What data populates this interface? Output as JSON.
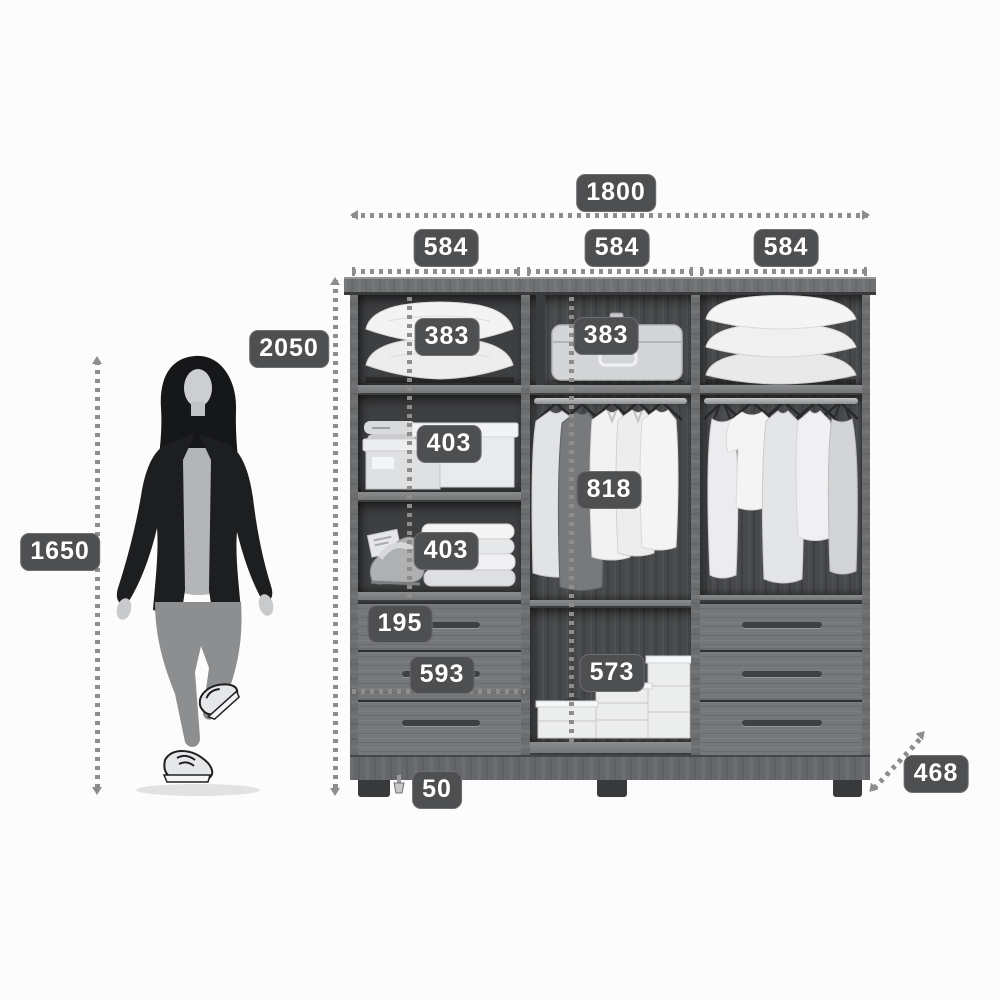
{
  "unit": "mm",
  "dimensions": {
    "width_total": "1800",
    "width_sections": [
      "584",
      "584",
      "584"
    ],
    "height_total": "2050",
    "person_height": "1650",
    "top_shelf_left": "383",
    "top_shelf_middle": "383",
    "middle_shelf_left": "403",
    "lower_shelf_left": "403",
    "hanging_space": "818",
    "top_drawer_height": "195",
    "drawer_width": "593",
    "shoe_compartment": "573",
    "foot_height": "50",
    "depth": "468"
  },
  "colors": {
    "background": "#fcfcfc",
    "label_background": "#4e4f51",
    "label_text": "#ffffff",
    "dimension_line": "#8d8d8d",
    "cabinet_frame": "#6f7173",
    "cabinet_interior": "#47494b",
    "drawer_front": "#757779",
    "contents_light": "#efefef"
  }
}
